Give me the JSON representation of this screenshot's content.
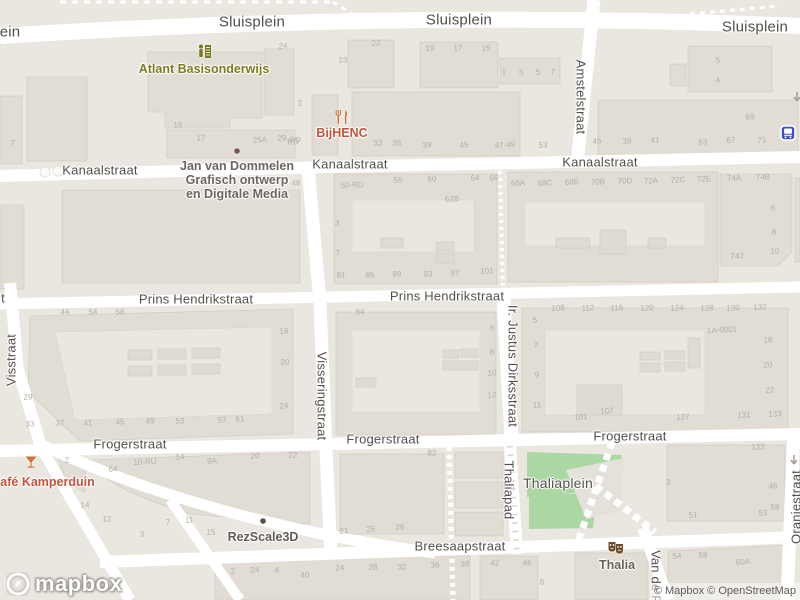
{
  "attribution": {
    "text": "© Mapbox © OpenStreetMap",
    "logo_text": "mapbox"
  },
  "colors": {
    "background": "#eae7e1",
    "road": "#ffffff",
    "building": "#e1ddd4",
    "building_outline": "#cdc8bd",
    "courtyard": "#eae7e1",
    "park_green": "#abd7a2",
    "street_label": "#53504a",
    "house_number": "#b4aea2",
    "school_poi": "#7c7820",
    "food_poi_icon": "#d4703f",
    "food_poi_text": "#c2553a",
    "generic_poi_text": "#6b665e",
    "theater_brown": "#6f4b2e",
    "bus_blue": "#3d4ec2",
    "jvd_dot": "#7d5650",
    "rez_dot": "#55504a"
  },
  "street_labels": [
    {
      "text": "Sluisplein",
      "x": 252,
      "y": 22,
      "size": 15
    },
    {
      "text": "Sluisplein",
      "x": 459,
      "y": 20,
      "size": 15
    },
    {
      "text": "Sluisplein",
      "x": 755,
      "y": 27,
      "size": 15
    },
    {
      "text": "ein",
      "x": 10,
      "y": 32,
      "size": 15
    },
    {
      "text": "Kanaalstraat",
      "x": 100,
      "y": 170
    },
    {
      "text": "Kanaalstraat",
      "x": 350,
      "y": 164
    },
    {
      "text": "Kanaalstraat",
      "x": 600,
      "y": 162
    },
    {
      "text": "Prins Hendrikstraat",
      "x": 196,
      "y": 299
    },
    {
      "text": "Prins Hendrikstraat",
      "x": 447,
      "y": 296
    },
    {
      "text": "t",
      "x": 3,
      "y": 298
    },
    {
      "text": "Frogerstraat",
      "x": 130,
      "y": 444
    },
    {
      "text": "Frogerstraat",
      "x": 383,
      "y": 439
    },
    {
      "text": "Frogerstraat",
      "x": 630,
      "y": 436
    },
    {
      "text": "Breesaapstraat",
      "x": 460,
      "y": 546
    },
    {
      "text": "Thaliaplein",
      "x": 558,
      "y": 483,
      "size": 14
    },
    {
      "text": "Amstelstraat",
      "x": 581,
      "y": 97,
      "rot": 90
    },
    {
      "text": "Visstraat",
      "x": 11,
      "y": 360,
      "rot": -90
    },
    {
      "text": "Visseringstraat",
      "x": 322,
      "y": 396,
      "rot": 90
    },
    {
      "text": "Ir. Justus Dirksstraat",
      "x": 513,
      "y": 366,
      "rot": 90
    },
    {
      "text": "Thaliapad",
      "x": 509,
      "y": 490,
      "rot": 90
    },
    {
      "text": "Van de P",
      "x": 656,
      "y": 577,
      "rot": 90
    },
    {
      "text": "Oranjestraat",
      "x": 796,
      "y": 507,
      "rot": -90
    }
  ],
  "pois": [
    {
      "name": "atlant-basisonderwijs",
      "icon": "school-icon",
      "icon_x": 205,
      "icon_y": 52,
      "x": 204,
      "y": 69,
      "color": "#7d7a1f",
      "lines": [
        "Atlant Basisonderwijs"
      ]
    },
    {
      "name": "bijhenc",
      "icon": "restaurant-icon",
      "icon_x": 342,
      "icon_y": 117,
      "x": 342,
      "y": 133,
      "color": "#c2553a",
      "lines": [
        "BijHENC"
      ]
    },
    {
      "name": "cafe-kamperduin",
      "icon": "cocktail-icon",
      "icon_x": 31,
      "icon_y": 462,
      "x": 43,
      "y": 482,
      "color": "#c2553a",
      "lines": [
        "Café Kamperduin"
      ]
    },
    {
      "name": "jan-van-dommelen",
      "icon": "jvd-dot-icon",
      "icon_x": 237,
      "icon_y": 151,
      "x": 237,
      "y": 180,
      "color": "#6b665e",
      "lines": [
        "Jan van Dommelen",
        "Grafisch ontwerp",
        "en Digitale Media"
      ]
    },
    {
      "name": "rezscale3d",
      "icon": "rez-dot-icon",
      "icon_x": 263,
      "icon_y": 521,
      "x": 263,
      "y": 537,
      "color": "#615c54",
      "lines": [
        "RezScale3D"
      ]
    },
    {
      "name": "thalia",
      "icon": "theater-icon",
      "icon_x": 616,
      "icon_y": 548,
      "x": 617,
      "y": 565,
      "color": "#6a6156",
      "lines": [
        "Thalia"
      ]
    },
    {
      "name": "bus-stop",
      "icon": "bus-icon",
      "icon_x": 788,
      "icon_y": 133,
      "x": 788,
      "y": 133,
      "color": "",
      "lines": []
    }
  ],
  "house_numbers": [
    {
      "t": "7",
      "x": 13,
      "y": 143
    },
    {
      "t": "24",
      "x": 283,
      "y": 46
    },
    {
      "t": "22",
      "x": 376,
      "y": 43
    },
    {
      "t": "23",
      "x": 343,
      "y": 60
    },
    {
      "t": "2",
      "x": 300,
      "y": 103
    },
    {
      "t": "16",
      "x": 178,
      "y": 125
    },
    {
      "t": "17",
      "x": 201,
      "y": 138
    },
    {
      "t": "25A",
      "x": 260,
      "y": 140
    },
    {
      "t": "29",
      "x": 282,
      "y": 138
    },
    {
      "t": "RD",
      "x": 295,
      "y": 140
    },
    {
      "t": "19",
      "x": 430,
      "y": 48
    },
    {
      "t": "17",
      "x": 458,
      "y": 48
    },
    {
      "t": "15",
      "x": 486,
      "y": 48
    },
    {
      "t": "1",
      "x": 504,
      "y": 72
    },
    {
      "t": "3",
      "x": 521,
      "y": 72
    },
    {
      "t": "5",
      "x": 538,
      "y": 72
    },
    {
      "t": "7",
      "x": 553,
      "y": 72
    },
    {
      "t": "39",
      "x": 427,
      "y": 145
    },
    {
      "t": "45",
      "x": 464,
      "y": 145
    },
    {
      "t": "47-49",
      "x": 505,
      "y": 145
    },
    {
      "t": "53",
      "x": 543,
      "y": 145
    },
    {
      "t": "RD",
      "x": 293,
      "y": 142
    },
    {
      "t": "33",
      "x": 378,
      "y": 143
    },
    {
      "t": "35",
      "x": 397,
      "y": 143
    },
    {
      "t": "5",
      "x": 718,
      "y": 60
    },
    {
      "t": "4",
      "x": 718,
      "y": 80
    },
    {
      "t": "69",
      "x": 750,
      "y": 117
    },
    {
      "t": "45",
      "x": 597,
      "y": 141
    },
    {
      "t": "39",
      "x": 627,
      "y": 141
    },
    {
      "t": "41",
      "x": 655,
      "y": 140
    },
    {
      "t": "63",
      "x": 703,
      "y": 142
    },
    {
      "t": "67",
      "x": 731,
      "y": 140
    },
    {
      "t": "71",
      "x": 762,
      "y": 140
    },
    {
      "t": "48",
      "x": 296,
      "y": 183
    },
    {
      "t": "50-RD",
      "x": 352,
      "y": 185
    },
    {
      "t": "56",
      "x": 398,
      "y": 180
    },
    {
      "t": "60",
      "x": 432,
      "y": 179
    },
    {
      "t": "62B",
      "x": 452,
      "y": 199
    },
    {
      "t": "64",
      "x": 475,
      "y": 178
    },
    {
      "t": "66",
      "x": 494,
      "y": 178
    },
    {
      "t": "3",
      "x": 337,
      "y": 223
    },
    {
      "t": "7",
      "x": 338,
      "y": 253
    },
    {
      "t": "81",
      "x": 341,
      "y": 275
    },
    {
      "t": "85",
      "x": 370,
      "y": 275
    },
    {
      "t": "89",
      "x": 397,
      "y": 274
    },
    {
      "t": "93",
      "x": 428,
      "y": 274
    },
    {
      "t": "97",
      "x": 455,
      "y": 273
    },
    {
      "t": "101",
      "x": 487,
      "y": 271
    },
    {
      "t": "68A",
      "x": 518,
      "y": 183
    },
    {
      "t": "68C",
      "x": 545,
      "y": 183
    },
    {
      "t": "68E",
      "x": 572,
      "y": 182
    },
    {
      "t": "70B",
      "x": 598,
      "y": 182
    },
    {
      "t": "70D",
      "x": 625,
      "y": 181
    },
    {
      "t": "72A",
      "x": 651,
      "y": 181
    },
    {
      "t": "72C",
      "x": 678,
      "y": 180
    },
    {
      "t": "72E",
      "x": 704,
      "y": 179
    },
    {
      "t": "74A",
      "x": 734,
      "y": 178
    },
    {
      "t": "74B",
      "x": 763,
      "y": 177
    },
    {
      "t": "74J",
      "x": 737,
      "y": 256
    },
    {
      "t": "6",
      "x": 773,
      "y": 208
    },
    {
      "t": "8",
      "x": 774,
      "y": 232
    },
    {
      "t": "10",
      "x": 775,
      "y": 251
    },
    {
      "t": "44",
      "x": 65,
      "y": 312
    },
    {
      "t": "54",
      "x": 93,
      "y": 312
    },
    {
      "t": "58",
      "x": 120,
      "y": 312
    },
    {
      "t": "16",
      "x": 284,
      "y": 331
    },
    {
      "t": "20",
      "x": 285,
      "y": 362
    },
    {
      "t": "24",
      "x": 284,
      "y": 406
    },
    {
      "t": "29",
      "x": 28,
      "y": 397
    },
    {
      "t": "33",
      "x": 30,
      "y": 424
    },
    {
      "t": "37",
      "x": 60,
      "y": 423
    },
    {
      "t": "41",
      "x": 88,
      "y": 423
    },
    {
      "t": "45",
      "x": 120,
      "y": 422
    },
    {
      "t": "49",
      "x": 150,
      "y": 421
    },
    {
      "t": "53",
      "x": 180,
      "y": 421
    },
    {
      "t": "57",
      "x": 222,
      "y": 420
    },
    {
      "t": "61",
      "x": 240,
      "y": 419
    },
    {
      "t": "84",
      "x": 360,
      "y": 312
    },
    {
      "t": "6",
      "x": 492,
      "y": 328
    },
    {
      "t": "8",
      "x": 492,
      "y": 352
    },
    {
      "t": "10",
      "x": 492,
      "y": 373
    },
    {
      "t": "12",
      "x": 492,
      "y": 395
    },
    {
      "t": "5",
      "x": 535,
      "y": 320
    },
    {
      "t": "7",
      "x": 536,
      "y": 345
    },
    {
      "t": "9",
      "x": 537,
      "y": 375
    },
    {
      "t": "11",
      "x": 537,
      "y": 405
    },
    {
      "t": "108",
      "x": 558,
      "y": 308
    },
    {
      "t": "112",
      "x": 588,
      "y": 308
    },
    {
      "t": "116",
      "x": 617,
      "y": 308
    },
    {
      "t": "120",
      "x": 647,
      "y": 308
    },
    {
      "t": "124",
      "x": 677,
      "y": 308
    },
    {
      "t": "128",
      "x": 707,
      "y": 308
    },
    {
      "t": "130",
      "x": 733,
      "y": 308
    },
    {
      "t": "132",
      "x": 760,
      "y": 307
    },
    {
      "t": "1A-0001",
      "x": 722,
      "y": 330
    },
    {
      "t": "18",
      "x": 768,
      "y": 340
    },
    {
      "t": "20",
      "x": 768,
      "y": 365
    },
    {
      "t": "22",
      "x": 770,
      "y": 390
    },
    {
      "t": "101",
      "x": 581,
      "y": 417
    },
    {
      "t": "107",
      "x": 607,
      "y": 411
    },
    {
      "t": "127",
      "x": 683,
      "y": 417
    },
    {
      "t": "131",
      "x": 744,
      "y": 415
    },
    {
      "t": "133",
      "x": 775,
      "y": 414
    },
    {
      "t": "2",
      "x": 67,
      "y": 460
    },
    {
      "t": "64",
      "x": 113,
      "y": 469
    },
    {
      "t": "10-RU",
      "x": 145,
      "y": 462
    },
    {
      "t": "14",
      "x": 180,
      "y": 457
    },
    {
      "t": "9A",
      "x": 212,
      "y": 461
    },
    {
      "t": "20",
      "x": 255,
      "y": 456
    },
    {
      "t": "22",
      "x": 293,
      "y": 455
    },
    {
      "t": "14",
      "x": 85,
      "y": 505
    },
    {
      "t": "12",
      "x": 107,
      "y": 519
    },
    {
      "t": "7",
      "x": 168,
      "y": 522
    },
    {
      "t": "11",
      "x": 189,
      "y": 520
    },
    {
      "t": "3",
      "x": 142,
      "y": 534
    },
    {
      "t": "15",
      "x": 211,
      "y": 532
    },
    {
      "t": "21",
      "x": 344,
      "y": 531
    },
    {
      "t": "26",
      "x": 371,
      "y": 529
    },
    {
      "t": "26",
      "x": 400,
      "y": 527
    },
    {
      "t": "82",
      "x": 432,
      "y": 453
    },
    {
      "t": "132",
      "x": 758,
      "y": 447
    },
    {
      "t": "3",
      "x": 668,
      "y": 482
    },
    {
      "t": "46",
      "x": 773,
      "y": 486
    },
    {
      "t": "58",
      "x": 775,
      "y": 507
    },
    {
      "t": "51",
      "x": 693,
      "y": 515
    },
    {
      "t": "53",
      "x": 763,
      "y": 513
    },
    {
      "t": "2",
      "x": 233,
      "y": 571
    },
    {
      "t": "24",
      "x": 255,
      "y": 570
    },
    {
      "t": "4",
      "x": 277,
      "y": 570
    },
    {
      "t": "40",
      "x": 305,
      "y": 575
    },
    {
      "t": "24",
      "x": 340,
      "y": 568
    },
    {
      "t": "28",
      "x": 373,
      "y": 567
    },
    {
      "t": "32",
      "x": 402,
      "y": 567
    },
    {
      "t": "36",
      "x": 435,
      "y": 565
    },
    {
      "t": "38",
      "x": 465,
      "y": 564
    },
    {
      "t": "42",
      "x": 495,
      "y": 563
    },
    {
      "t": "46",
      "x": 527,
      "y": 563
    },
    {
      "t": "8",
      "x": 542,
      "y": 582
    },
    {
      "t": "54",
      "x": 677,
      "y": 556
    },
    {
      "t": "58",
      "x": 703,
      "y": 555
    },
    {
      "t": "60A",
      "x": 743,
      "y": 562
    }
  ]
}
